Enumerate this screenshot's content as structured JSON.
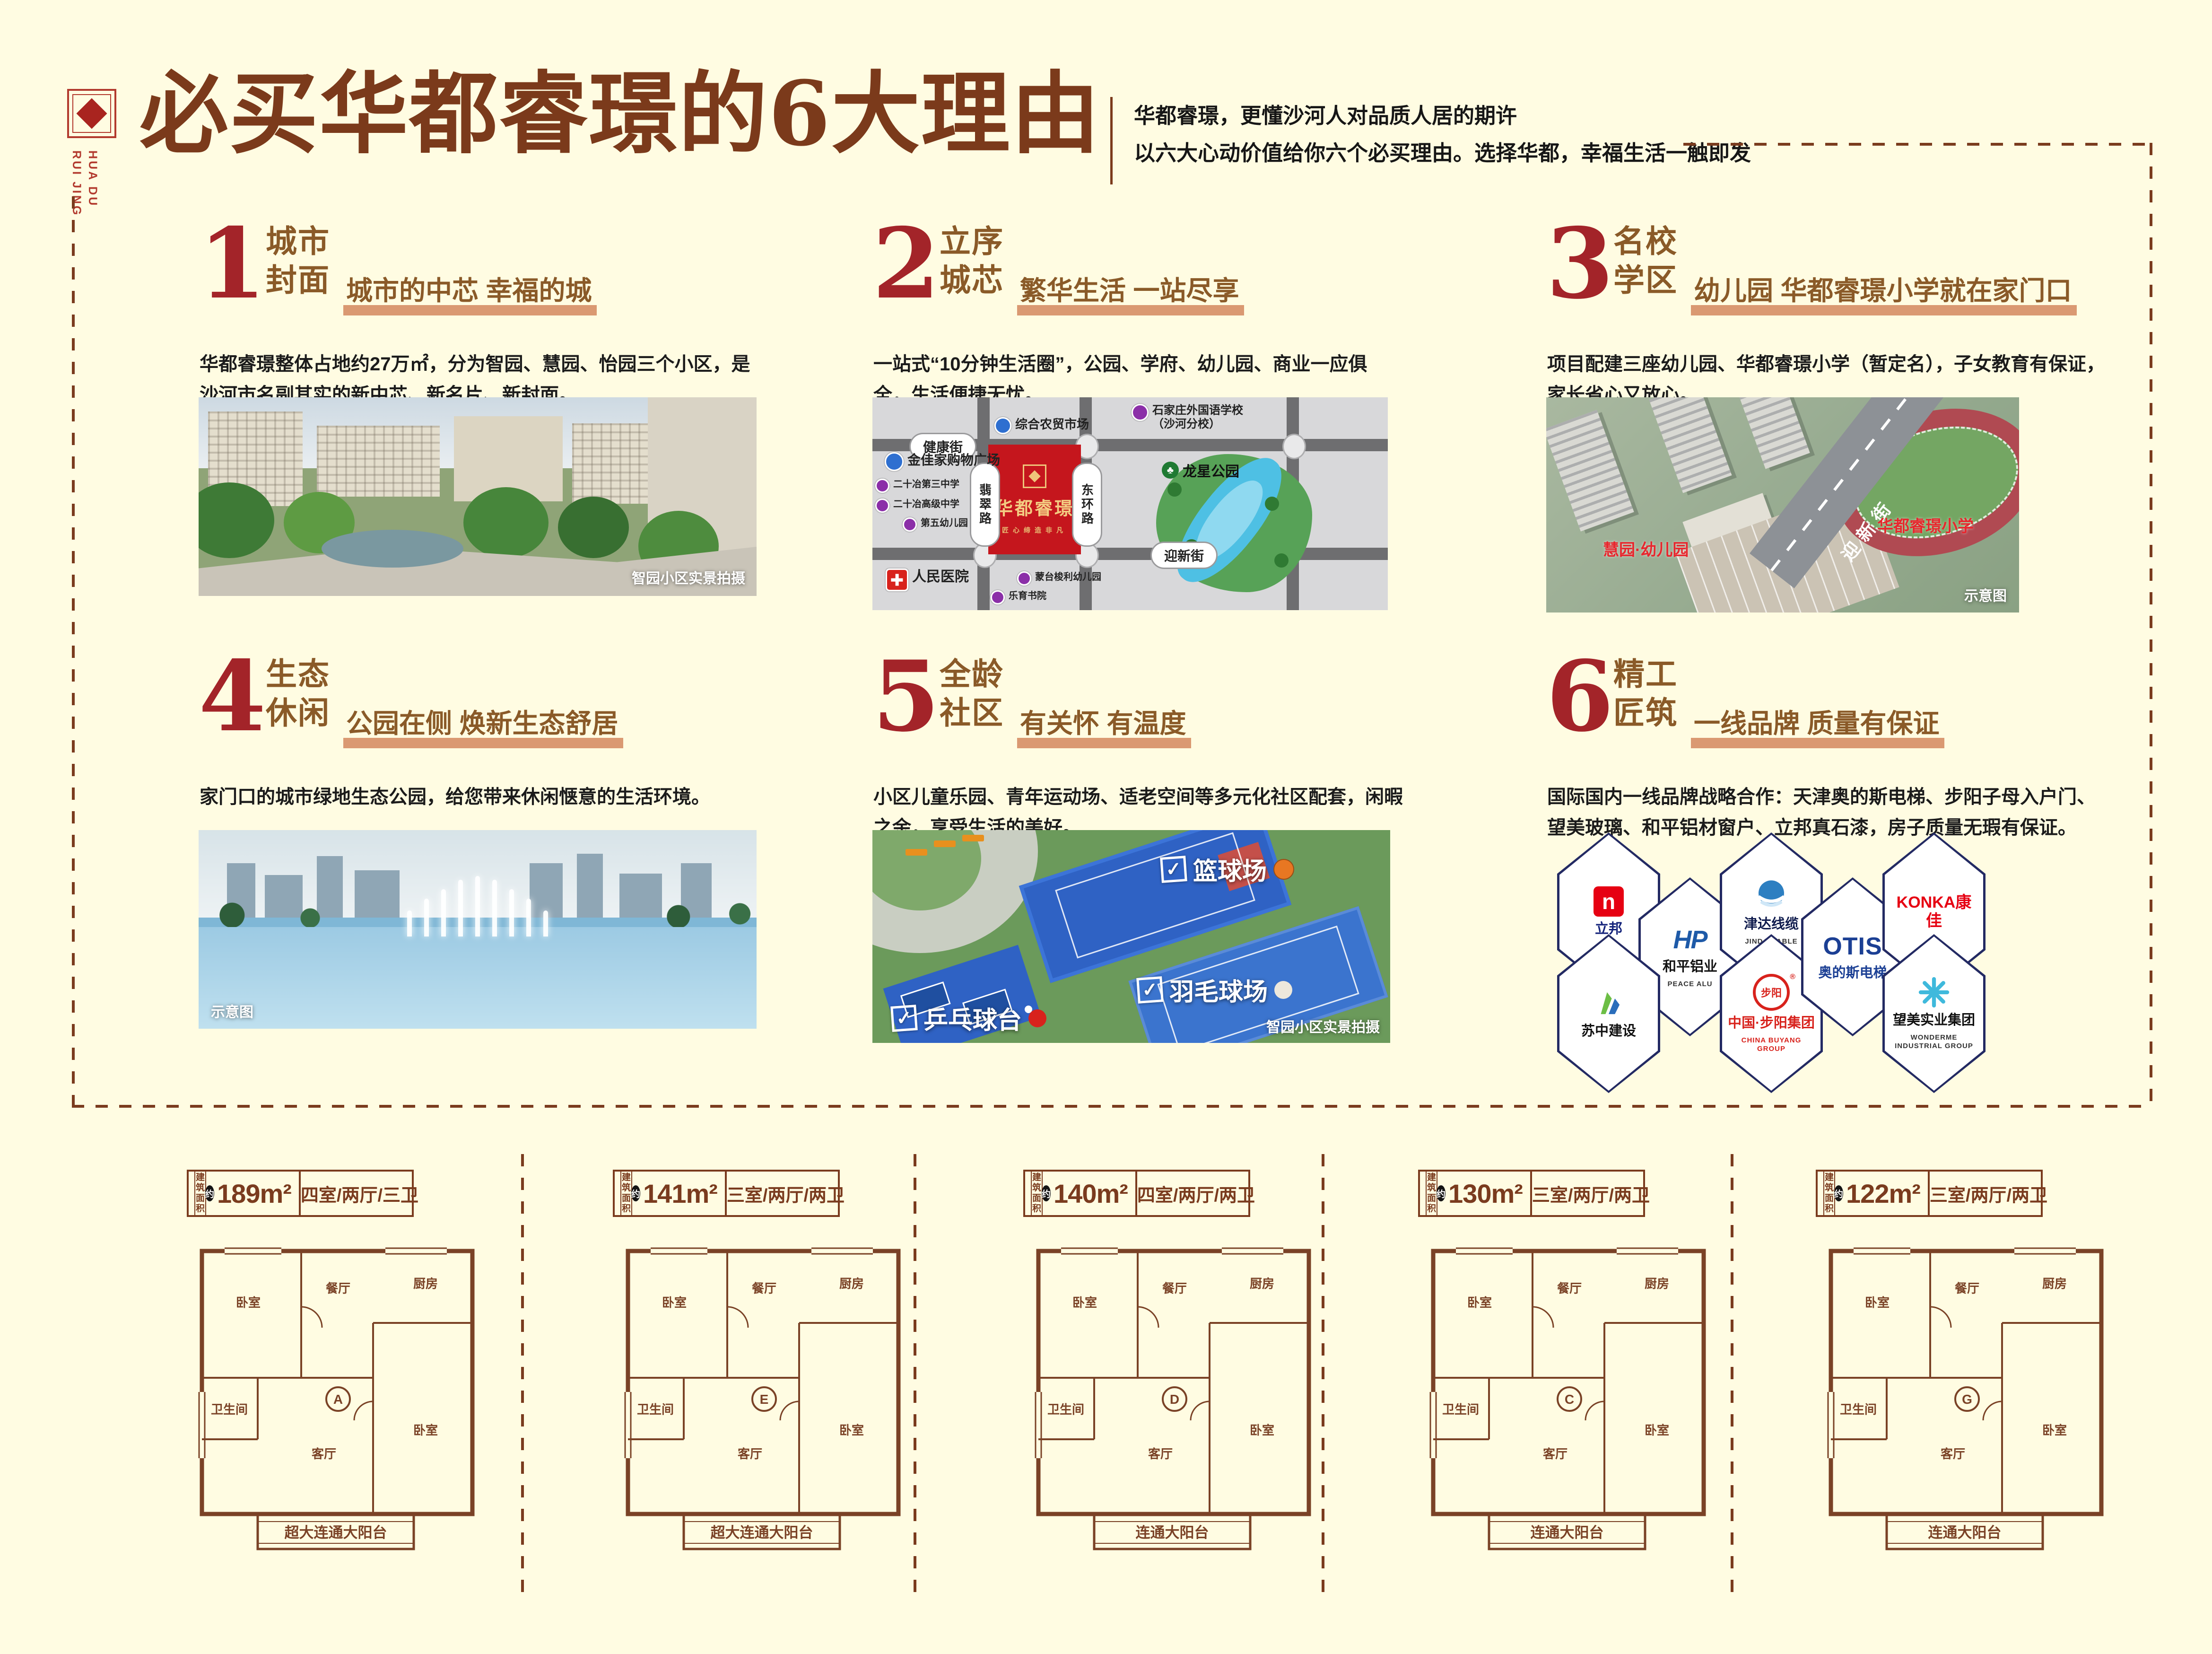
{
  "page_bg": "#FFFCE2",
  "logo": {
    "brand_text": "HUA DU\nRUI JING"
  },
  "header": {
    "title": "必买华都睿璟的6大理由",
    "subtitle_line1": "华都睿璟，更懂沙河人对品质人居的期许",
    "subtitle_line2": "以六大心动价值给你六个必买理由。选择华都，幸福生活一触即发"
  },
  "sections": [
    {
      "num": "1",
      "t1": "城市",
      "t2": "封面",
      "tagline": "城市的中芯 幸福的城",
      "body": "华都睿璟整体占地约27万㎡，分为智园、慧园、怡园三个小区，是沙河市名副其实的新中芯、新名片、新封面。",
      "caption": "智园小区实景拍摄"
    },
    {
      "num": "2",
      "t1": "立序",
      "t2": "城芯",
      "tagline": "繁华生活 一站尽享",
      "body": "一站式“10分钟生活圈”，公园、学府、幼儿园、商业一应俱全，生活便捷无忧。"
    },
    {
      "num": "3",
      "t1": "名校",
      "t2": "学区",
      "tagline": "幼儿园 华都睿璟小学就在家门口",
      "body": "项目配建三座幼儿园、华都睿璟小学（暂定名），子女教育有保证，家长省心又放心。",
      "caption": "示意图"
    },
    {
      "num": "4",
      "t1": "生态",
      "t2": "休闲",
      "tagline": "公园在侧 焕新生态舒居",
      "body": "家门口的城市绿地生态公园，给您带来休闲惬意的生活环境。",
      "caption": "示意图"
    },
    {
      "num": "5",
      "t1": "全龄",
      "t2": "社区",
      "tagline": "有关怀 有温度",
      "body": "小区儿童乐园、青年运动场、适老空间等多元化社区配套，闲暇之余，享受生活的美好。",
      "caption": "智园小区实景拍摄"
    },
    {
      "num": "6",
      "t1": "精工",
      "t2": "匠筑",
      "tagline": "一线品牌 质量有保证",
      "body": "国际国内一线品牌战略合作：天津奥的斯电梯、步阳子母入户门、望美玻璃、和平铝材窗户、立邦真石漆，房子质量无瑕有保证。"
    }
  ],
  "map": {
    "project": {
      "name": "华都睿璟",
      "slogan": "匠心缔造非凡",
      "block_color": "#C5161D"
    },
    "streets": {
      "north": "健康街",
      "south": "迎新街",
      "west": "翡翠路",
      "east": "东环路"
    },
    "park_name": "龙星公园",
    "pois": [
      {
        "name": "综合农贸市场",
        "type": "market",
        "color": "#2E6FD0"
      },
      {
        "name": "石家庄外国语学校\n（沙河分校）",
        "type": "school",
        "color": "#8B2FA8"
      },
      {
        "name": "金佳家购物广场",
        "type": "mall",
        "color": "#2E6FD0"
      },
      {
        "name": "二十冶第三中学",
        "type": "school",
        "color": "#8B2FA8"
      },
      {
        "name": "二十冶高级中学",
        "type": "school",
        "color": "#8B2FA8"
      },
      {
        "name": "第五幼儿园",
        "type": "kindergarten",
        "color": "#8B2FA8"
      },
      {
        "name": "人民医院",
        "type": "hospital",
        "color": "#D8221C"
      },
      {
        "name": "蒙台梭利幼儿园",
        "type": "kindergarten",
        "color": "#8B2FA8"
      },
      {
        "name": "乐育书院",
        "type": "academy",
        "color": "#8B2FA8"
      }
    ]
  },
  "aerial": {
    "kindergarten_label": "慧园·幼儿园",
    "school_label": "华都睿璟小学",
    "road_label": "迎新街",
    "caption": "示意图"
  },
  "sports": {
    "tags": [
      "篮球场",
      "羽毛球场",
      "乒乓球台"
    ],
    "caption": "智园小区实景拍摄"
  },
  "brands": [
    {
      "cn": "立邦",
      "en": "",
      "mark": "nippon",
      "mark_text": "n",
      "cn_color": "#13227A"
    },
    {
      "cn": "和平铝业",
      "en": "PEACE ALU",
      "mark": "hp",
      "mark_text": "HP",
      "cn_color": "#111111"
    },
    {
      "cn": "津达线缆",
      "en": "JINDA CABLE",
      "mark": "globe",
      "mark_text": "",
      "cn_color": "#0F1B4D"
    },
    {
      "cn": "中国·步阳集团",
      "en": "CHINA BUYANG GROUP",
      "mark": "buyang",
      "mark_text": "步阳",
      "cn_color": "#D8221C",
      "en_color": "#D8221C"
    },
    {
      "cn": "奥的斯电梯",
      "en": "",
      "mark": "otis",
      "mark_text": "OTIS",
      "cn_color": "#1B3F94"
    },
    {
      "cn": "KONKA康佳",
      "en": "",
      "mark": "none",
      "mark_text": "",
      "cn_color": "#E60012"
    },
    {
      "cn": "苏中建设",
      "en": "",
      "mark": "suzhong",
      "mark_text": "",
      "cn_color": "#111111"
    },
    {
      "cn": "望美实业集团",
      "en": "WONDERME INDUSTRIAL GROUP",
      "mark": "wonderme",
      "mark_text": "",
      "cn_color": "#111111"
    }
  ],
  "floorplans": {
    "common": {
      "area_prefix": "建筑面积",
      "approx": "约",
      "room_labels": [
        "卧室",
        "餐厅",
        "厨房",
        "卫生间",
        "客厅"
      ]
    },
    "plans": [
      {
        "area": "189m²",
        "rooms": "四室/两厅/三卫",
        "balcony": "超大连通大阳台",
        "unit": "A"
      },
      {
        "area": "141m²",
        "rooms": "三室/两厅/两卫",
        "balcony": "超大连通大阳台",
        "unit": "E"
      },
      {
        "area": "140m²",
        "rooms": "四室/两厅/两卫",
        "balcony": "连通大阳台",
        "unit": "D"
      },
      {
        "area": "130m²",
        "rooms": "三室/两厅/两卫",
        "balcony": "连通大阳台",
        "unit": "C"
      },
      {
        "area": "122m²",
        "rooms": "三室/两厅/两卫",
        "balcony": "连通大阳台",
        "unit": "G"
      }
    ]
  }
}
